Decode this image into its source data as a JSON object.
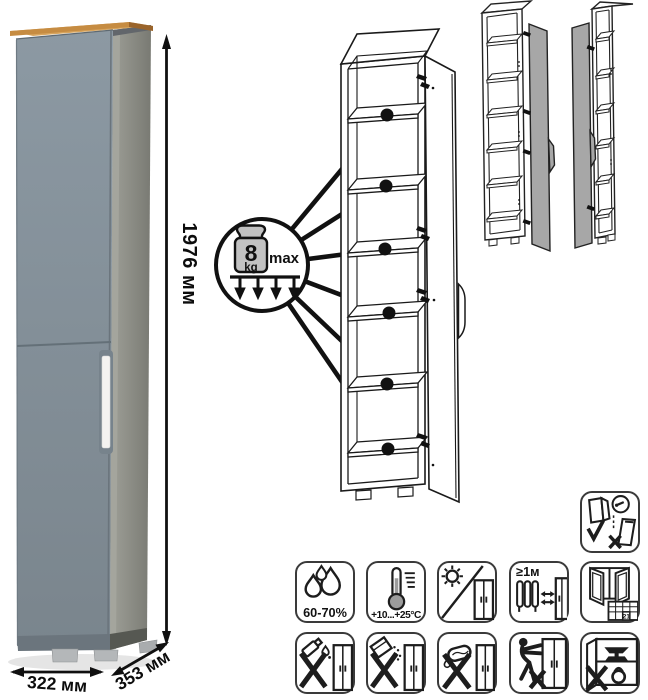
{
  "product": {
    "height_label": "1976 мм",
    "width_label": "322 мм",
    "depth_label": "353 мм",
    "colors": {
      "door_front": "#8895A0",
      "side_panel": "#8C8D85",
      "top_board_wood": "#C9914A",
      "handle": "#F4F3F1",
      "drawing_line": "#1A1A1A",
      "variant_door_fill": "#A7A7A7"
    }
  },
  "shelf_load_callout": {
    "weight_value": "8",
    "weight_unit": "kg",
    "qualifier": "max",
    "shelf_count": 6
  },
  "icon_grid": {
    "anchor": {
      "name": "wall-anchor-warning-icon"
    },
    "row1": [
      {
        "name": "humidity-icon",
        "label": "60-70%"
      },
      {
        "name": "temperature-icon",
        "label": "+10...+25°C"
      },
      {
        "name": "no-direct-sunlight-icon",
        "label": ""
      },
      {
        "name": "heat-source-distance-icon",
        "label": "≥1м"
      },
      {
        "name": "ventilation-icon",
        "label": "21"
      }
    ],
    "row2": [
      {
        "name": "no-liquids-icon"
      },
      {
        "name": "no-abrasive-powder-icon"
      },
      {
        "name": "no-wet-cleaning-icon"
      },
      {
        "name": "no-dragging-icon"
      },
      {
        "name": "no-overloading-icon"
      }
    ]
  }
}
